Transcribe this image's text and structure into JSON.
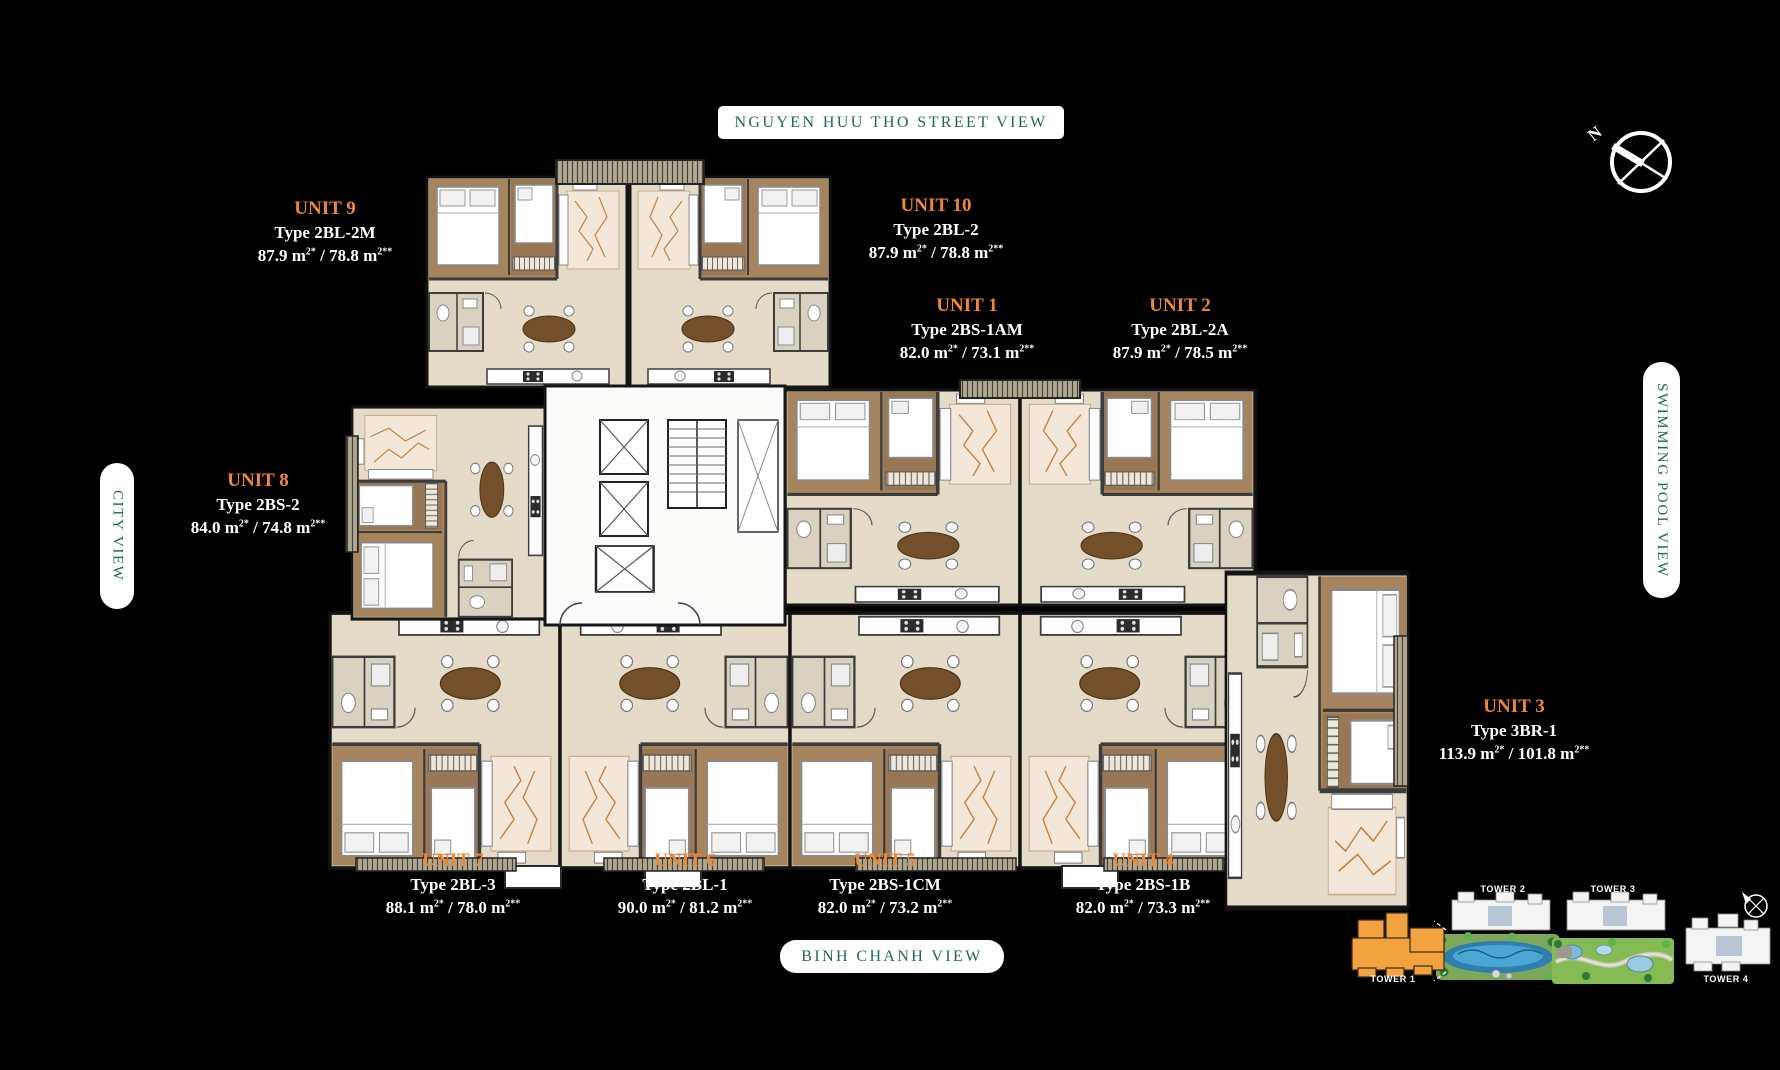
{
  "views": {
    "street": "NGUYEN HUU THO STREET VIEW",
    "city": "CITY VIEW",
    "pool": "SWIMMING POOL VIEW",
    "binh_chanh": "BINH CHANH VIEW"
  },
  "compass": {
    "north_label": "N"
  },
  "units": [
    {
      "name": "UNIT 1",
      "type": "Type 2BS-1AM",
      "area_main": "82.0 m",
      "area_sup": "2*",
      "area_rest": " / 73.1 m",
      "area_sup2": "2**"
    },
    {
      "name": "UNIT 2",
      "type": "Type 2BL-2A",
      "area_main": "87.9 m",
      "area_sup": "2*",
      "area_rest": " / 78.5 m",
      "area_sup2": "2**"
    },
    {
      "name": "UNIT 3",
      "type": "Type 3BR-1",
      "area_main": "113.9 m",
      "area_sup": "2*",
      "area_rest": " / 101.8 m",
      "area_sup2": "2**"
    },
    {
      "name": "UNIT 4",
      "type": "Type 2BS-1B",
      "area_main": "82.0 m",
      "area_sup": "2*",
      "area_rest": " / 73.3 m",
      "area_sup2": "2**"
    },
    {
      "name": "UNIT 5",
      "type": "Type 2BS-1CM",
      "area_main": "82.0 m",
      "area_sup": "2*",
      "area_rest": " / 73.2 m",
      "area_sup2": "2**"
    },
    {
      "name": "UNIT 6",
      "type": "Type 2BL-1",
      "area_main": "90.0 m",
      "area_sup": "2*",
      "area_rest": " / 81.2 m",
      "area_sup2": "2**"
    },
    {
      "name": "UNIT 7",
      "type": "Type 2BL-3",
      "area_main": "88.1 m",
      "area_sup": "2*",
      "area_rest": " / 78.0 m",
      "area_sup2": "2**"
    },
    {
      "name": "UNIT 8",
      "type": "Type 2BS-2",
      "area_main": "84.0 m",
      "area_sup": "2*",
      "area_rest": " / 74.8 m",
      "area_sup2": "2**"
    },
    {
      "name": "UNIT 9",
      "type": "Type 2BL-2M",
      "area_main": "87.9 m",
      "area_sup": "2*",
      "area_rest": " / 78.8 m",
      "area_sup2": "2**"
    },
    {
      "name": "UNIT 10",
      "type": "Type 2BL-2",
      "area_main": "87.9 m",
      "area_sup": "2*",
      "area_rest": " / 78.8 m",
      "area_sup2": "2**"
    }
  ],
  "site_map": {
    "towers": [
      {
        "label": "TOWER 1",
        "highlighted": true
      },
      {
        "label": "TOWER 2",
        "highlighted": false
      },
      {
        "label": "TOWER 3",
        "highlighted": false
      },
      {
        "label": "TOWER 4",
        "highlighted": false
      }
    ]
  },
  "colors": {
    "accent_orange": "#ee8833",
    "label_green": "#1e6b45",
    "tower_highlight": "#f2a340",
    "background": "#000000"
  }
}
